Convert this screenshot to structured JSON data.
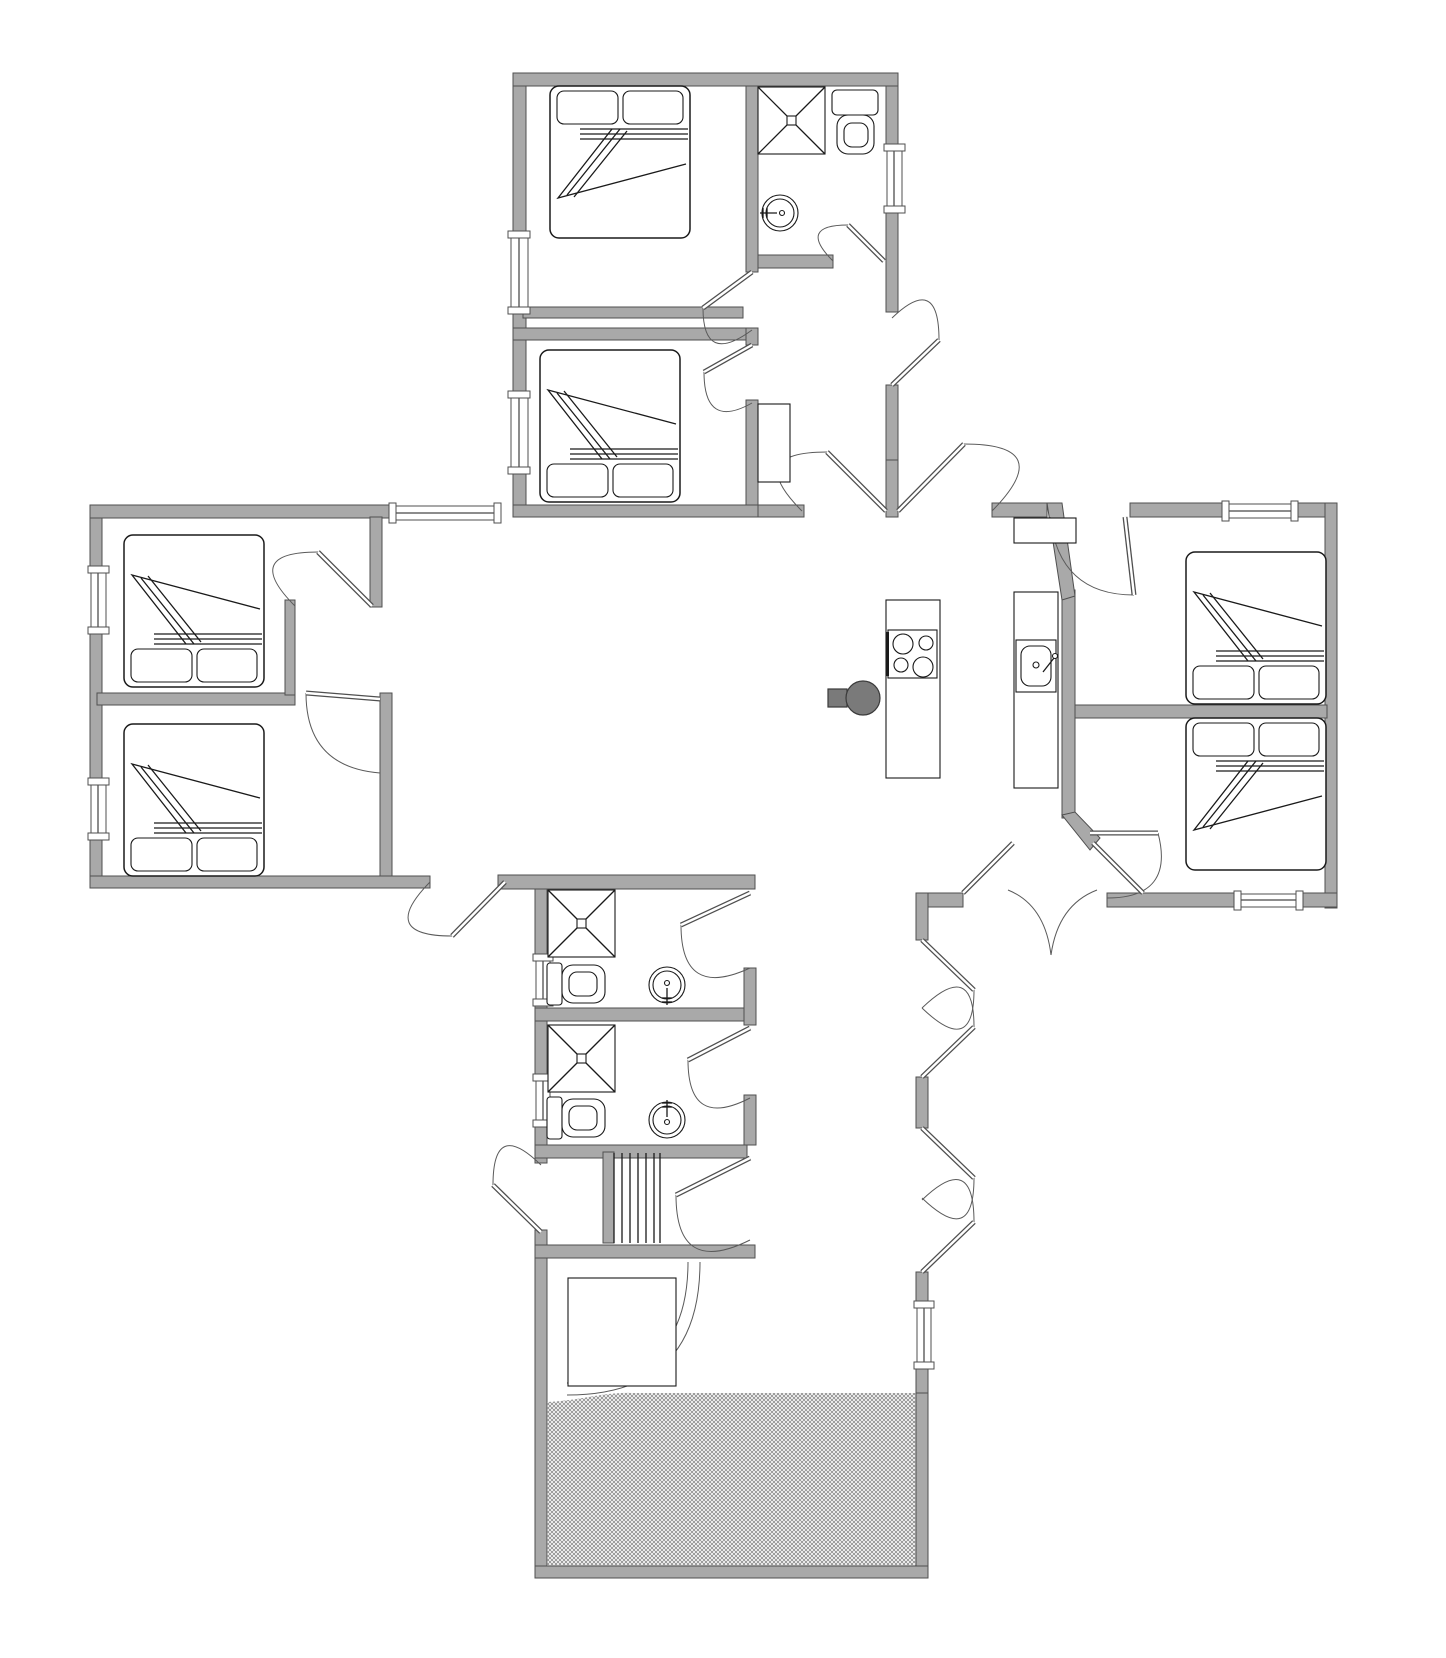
{
  "document": {
    "type": "architectural floor plan",
    "description": "single-storey cross-shaped house plan, no text labels"
  },
  "colors": {
    "background": "#ffffff",
    "wall": "#a9a9a9",
    "wall_stroke": "#4f4f4f",
    "line": "#1a1a1a",
    "stove": "#7a7a7a",
    "hatch": "#8f8f8f"
  },
  "inventory": {
    "bedrooms": 6,
    "double_beds": 6,
    "bathrooms": 3,
    "showers": 3,
    "toilets": 3,
    "washbasins": 3,
    "kitchen": {
      "island": 1,
      "cooktop_burners": 4,
      "sink_counter": 1,
      "wall_cabinet": 1,
      "wood_stove": 1
    },
    "stairs": 1,
    "terrace_hatched": 1,
    "windows": 11,
    "swing_doors": 21,
    "main_entrance_door": 1
  }
}
